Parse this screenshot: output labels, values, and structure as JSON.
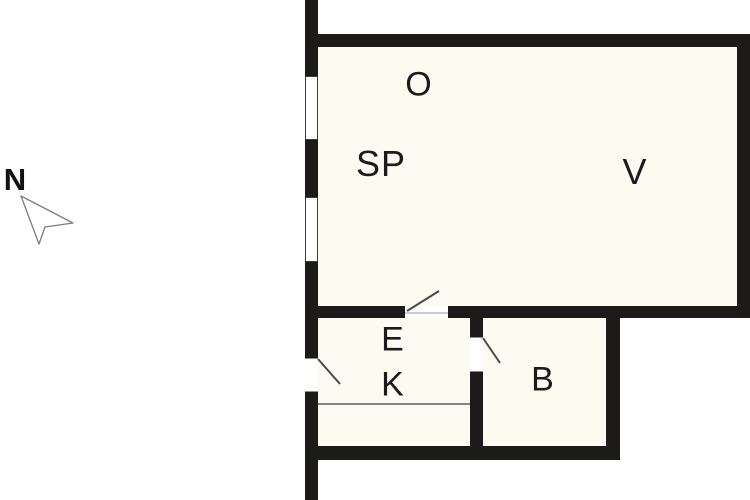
{
  "compass": {
    "label": "N"
  },
  "rooms": {
    "o": {
      "label": "O"
    },
    "sp": {
      "label": "SP"
    },
    "v": {
      "label": "V"
    },
    "e": {
      "label": "E"
    },
    "k": {
      "label": "K"
    },
    "b": {
      "label": "B"
    }
  },
  "colors": {
    "wall": "#1d1b19",
    "interior": "#fbfbf2",
    "outside": "#ffffff",
    "door-line": "#4a4a4a",
    "frame-line": "#8a8a8a",
    "label": "#1b1b1b",
    "compass-stroke": "#7d7d7d"
  }
}
